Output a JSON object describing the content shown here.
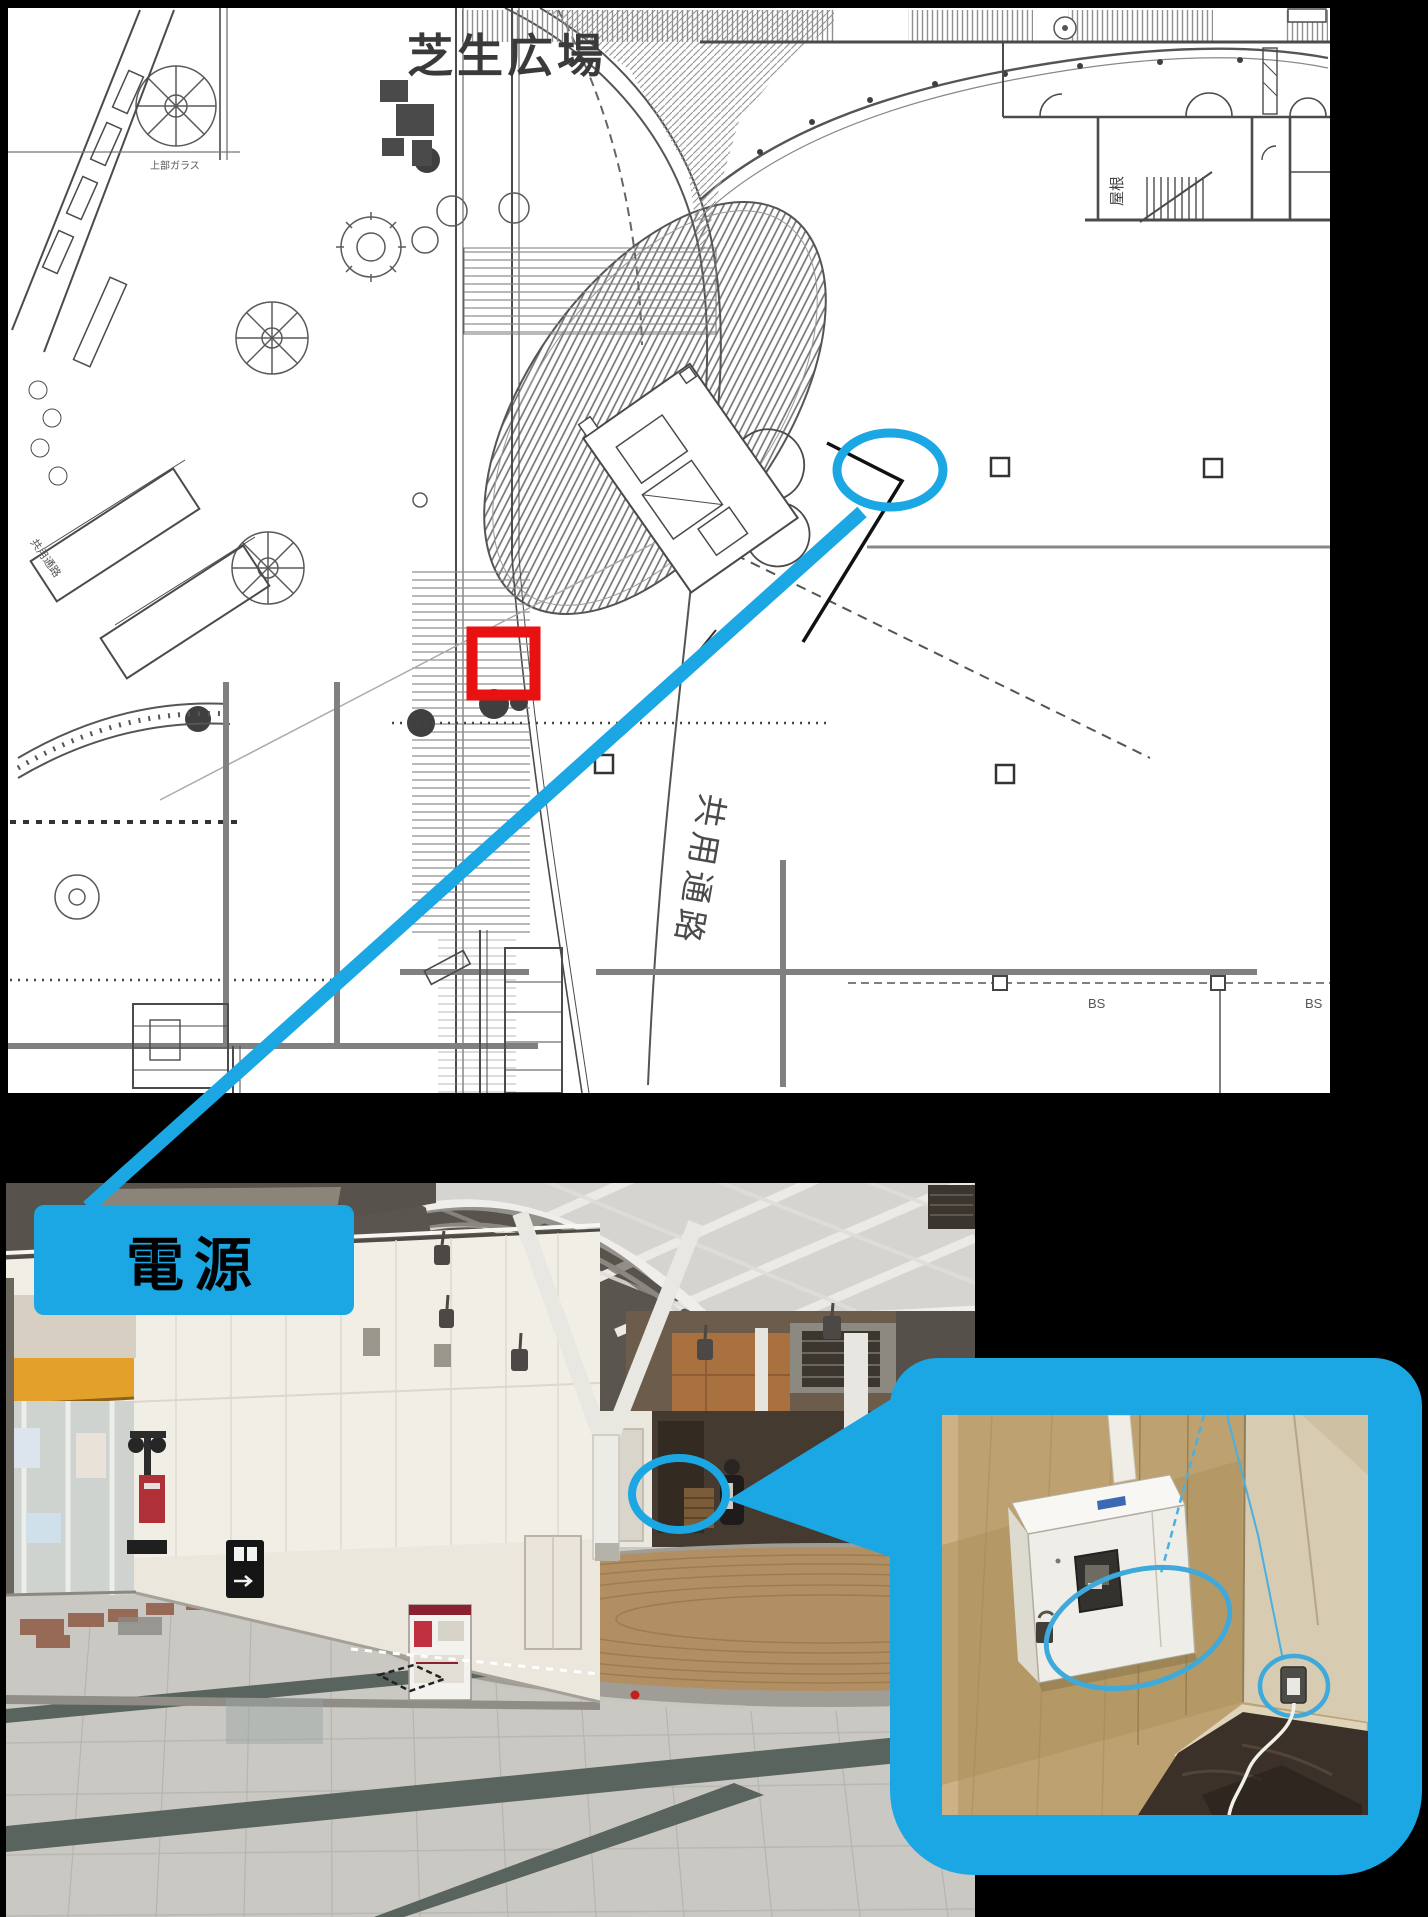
{
  "colors": {
    "background": "#000000",
    "accent_blue": "#1ba7e3",
    "marker_red": "#ea1111",
    "plan_paper": "#ffffff",
    "plan_ink": "#4b4b4b",
    "plan_gray": "#808080"
  },
  "floor_plan": {
    "area_label": "芝生広場",
    "corridor_label": "共用通路",
    "corridor_label_small": "共用通路",
    "roof_label": "屋根",
    "glass_label": "上部ガラス",
    "grid_label": "BS"
  },
  "photo": {
    "power_label": "電源"
  }
}
